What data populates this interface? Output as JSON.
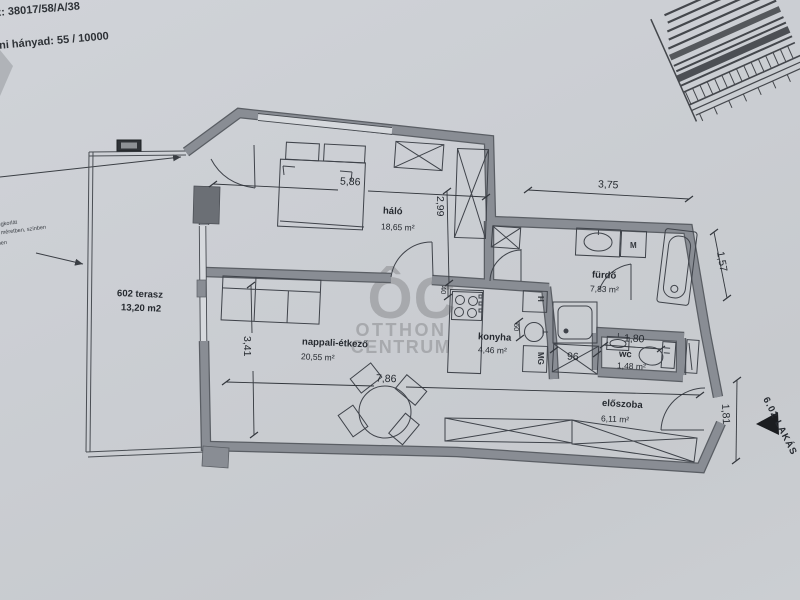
{
  "header": {
    "line1": "z: 38017/58/A/38",
    "line2": "doni hányad: 55 / 10000"
  },
  "note": {
    "line1": "biztonsági üvegkorlát",
    "line2": "típus szerint méretben, színben",
    "line3": "ben"
  },
  "watermark": {
    "monogram": "ÔC",
    "word1": "OTTHON",
    "word2": "CENTRUM",
    "color": "#a3a5a9"
  },
  "rooms": {
    "halo": {
      "name": "háló",
      "area": "18,65 m²"
    },
    "nappali": {
      "name": "nappali-étkező",
      "area": "20,55 m²"
    },
    "konyha": {
      "name": "konyha",
      "area": "4,46 m²"
    },
    "furdo": {
      "name": "fürdő",
      "area": "7,83 m²"
    },
    "wc": {
      "name": "wc",
      "area": "1,48 m²"
    },
    "eloszoba": {
      "name": "előszoba",
      "area": "6,11 m²"
    },
    "terasz": {
      "name": "602 terasz",
      "area": "13,20 m2"
    }
  },
  "dims": {
    "bedroom_width": "5,86",
    "bedroom_depth": "2,99",
    "bath_width": "3,75",
    "right_upper": "1,57",
    "living_depth": "3,41",
    "living_width": "7,86",
    "wc_width": "1,80",
    "entry_height": "1,81",
    "wall_stub": "40",
    "sink_run": "60",
    "closet_width": "96"
  },
  "labels": {
    "fridge": "H",
    "dishwasher": "MG",
    "washer": "M",
    "entrance": "6.02 LAKÁS"
  },
  "colors": {
    "paper": "#cbced3",
    "wall_fill": "#898d94",
    "wall_edge": "#5a5e64",
    "line": "#3f434a",
    "text": "#262a30",
    "marker": "#1b1d20"
  }
}
